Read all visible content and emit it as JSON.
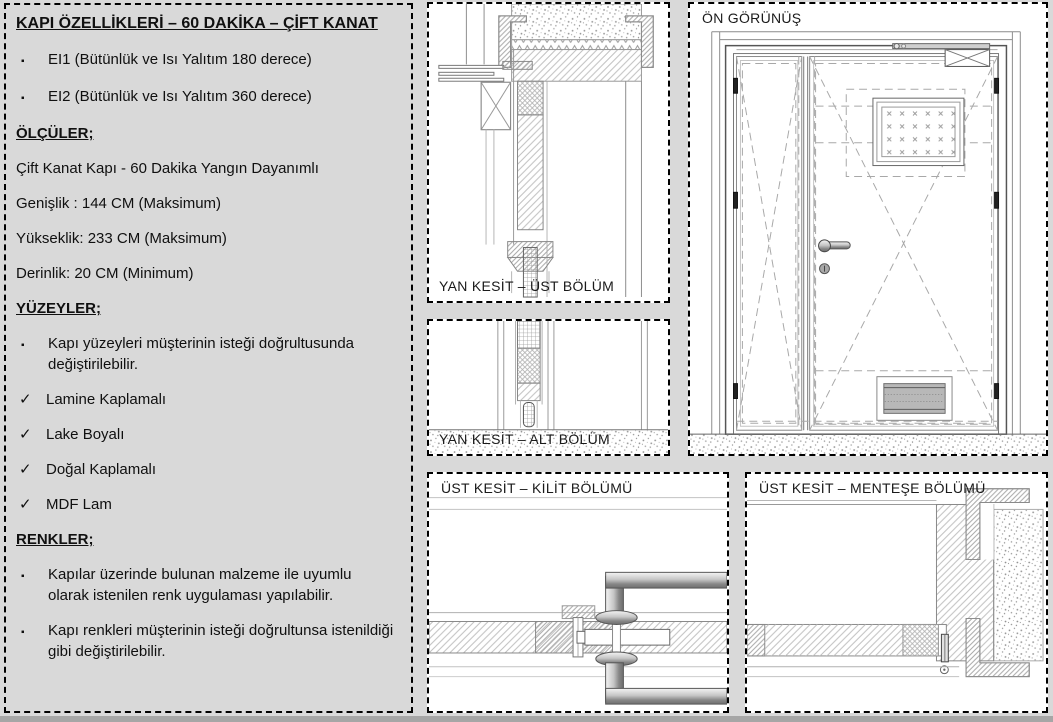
{
  "page": {
    "bg": "#d9d9d9",
    "panel_bg": "#ffffff",
    "border_color": "#000000",
    "line_color": "#8c8c8c",
    "hatch_color": "#c0c0c0",
    "metal_dark": "#6e6e6e",
    "grille_fill": "#b8b8b8"
  },
  "icons": {
    "bullet": "▪",
    "check": "✓"
  },
  "spec": {
    "items": [
      {
        "type": "title",
        "text": "KAPI ÖZELLİKLERİ – 60 DAKİKA – ÇİFT KANAT"
      },
      {
        "type": "bullet",
        "text": "EI1 (Bütünlük ve Isı Yalıtım 180 derece)"
      },
      {
        "type": "bullet",
        "text": "EI2 (Bütünlük ve Isı Yalıtım 360 derece)"
      },
      {
        "type": "heading",
        "text": "ÖLÇÜLER;"
      },
      {
        "type": "text",
        "text": "Çift Kanat Kapı - 60 Dakika Yangın Dayanımlı"
      },
      {
        "type": "text",
        "text": "Genişlik : 144 CM (Maksimum)"
      },
      {
        "type": "text",
        "text": "Yükseklik: 233 CM (Maksimum)"
      },
      {
        "type": "text",
        "text": "Derinlik: 20 CM (Minimum)"
      },
      {
        "type": "heading",
        "text": "YÜZEYLER;"
      },
      {
        "type": "bullet",
        "text": "Kapı yüzeyleri müşterinin isteği doğrultusunda değiştirilebilir."
      },
      {
        "type": "check",
        "text": "Lamine Kaplamalı"
      },
      {
        "type": "check",
        "text": "Lake Boyalı"
      },
      {
        "type": "check",
        "text": "Doğal Kaplamalı"
      },
      {
        "type": "check",
        "text": "MDF Lam"
      },
      {
        "type": "heading",
        "text": "RENKLER;"
      },
      {
        "type": "bullet",
        "text": "Kapılar üzerinde bulunan malzeme ile uyumlu olarak istenilen renk uygulaması yapılabilir."
      },
      {
        "type": "bullet",
        "text": "Kapı renkleri müşterinin isteği doğrultunsa istenildiği gibi değiştirilebilir."
      }
    ]
  },
  "panels": {
    "side_top": {
      "label": "YAN KESİT – ÜST BÖLÜM"
    },
    "side_bottom": {
      "label": "YAN KESİT – ALT BÖLÜM"
    },
    "front": {
      "label": "ÖN GÖRÜNÜŞ"
    },
    "top_lock": {
      "label": "ÜST KESİT – KİLİT BÖLÜMÜ"
    },
    "top_hinge": {
      "label": "ÜST KESİT – MENTEŞE BÖLÜMÜ"
    }
  }
}
